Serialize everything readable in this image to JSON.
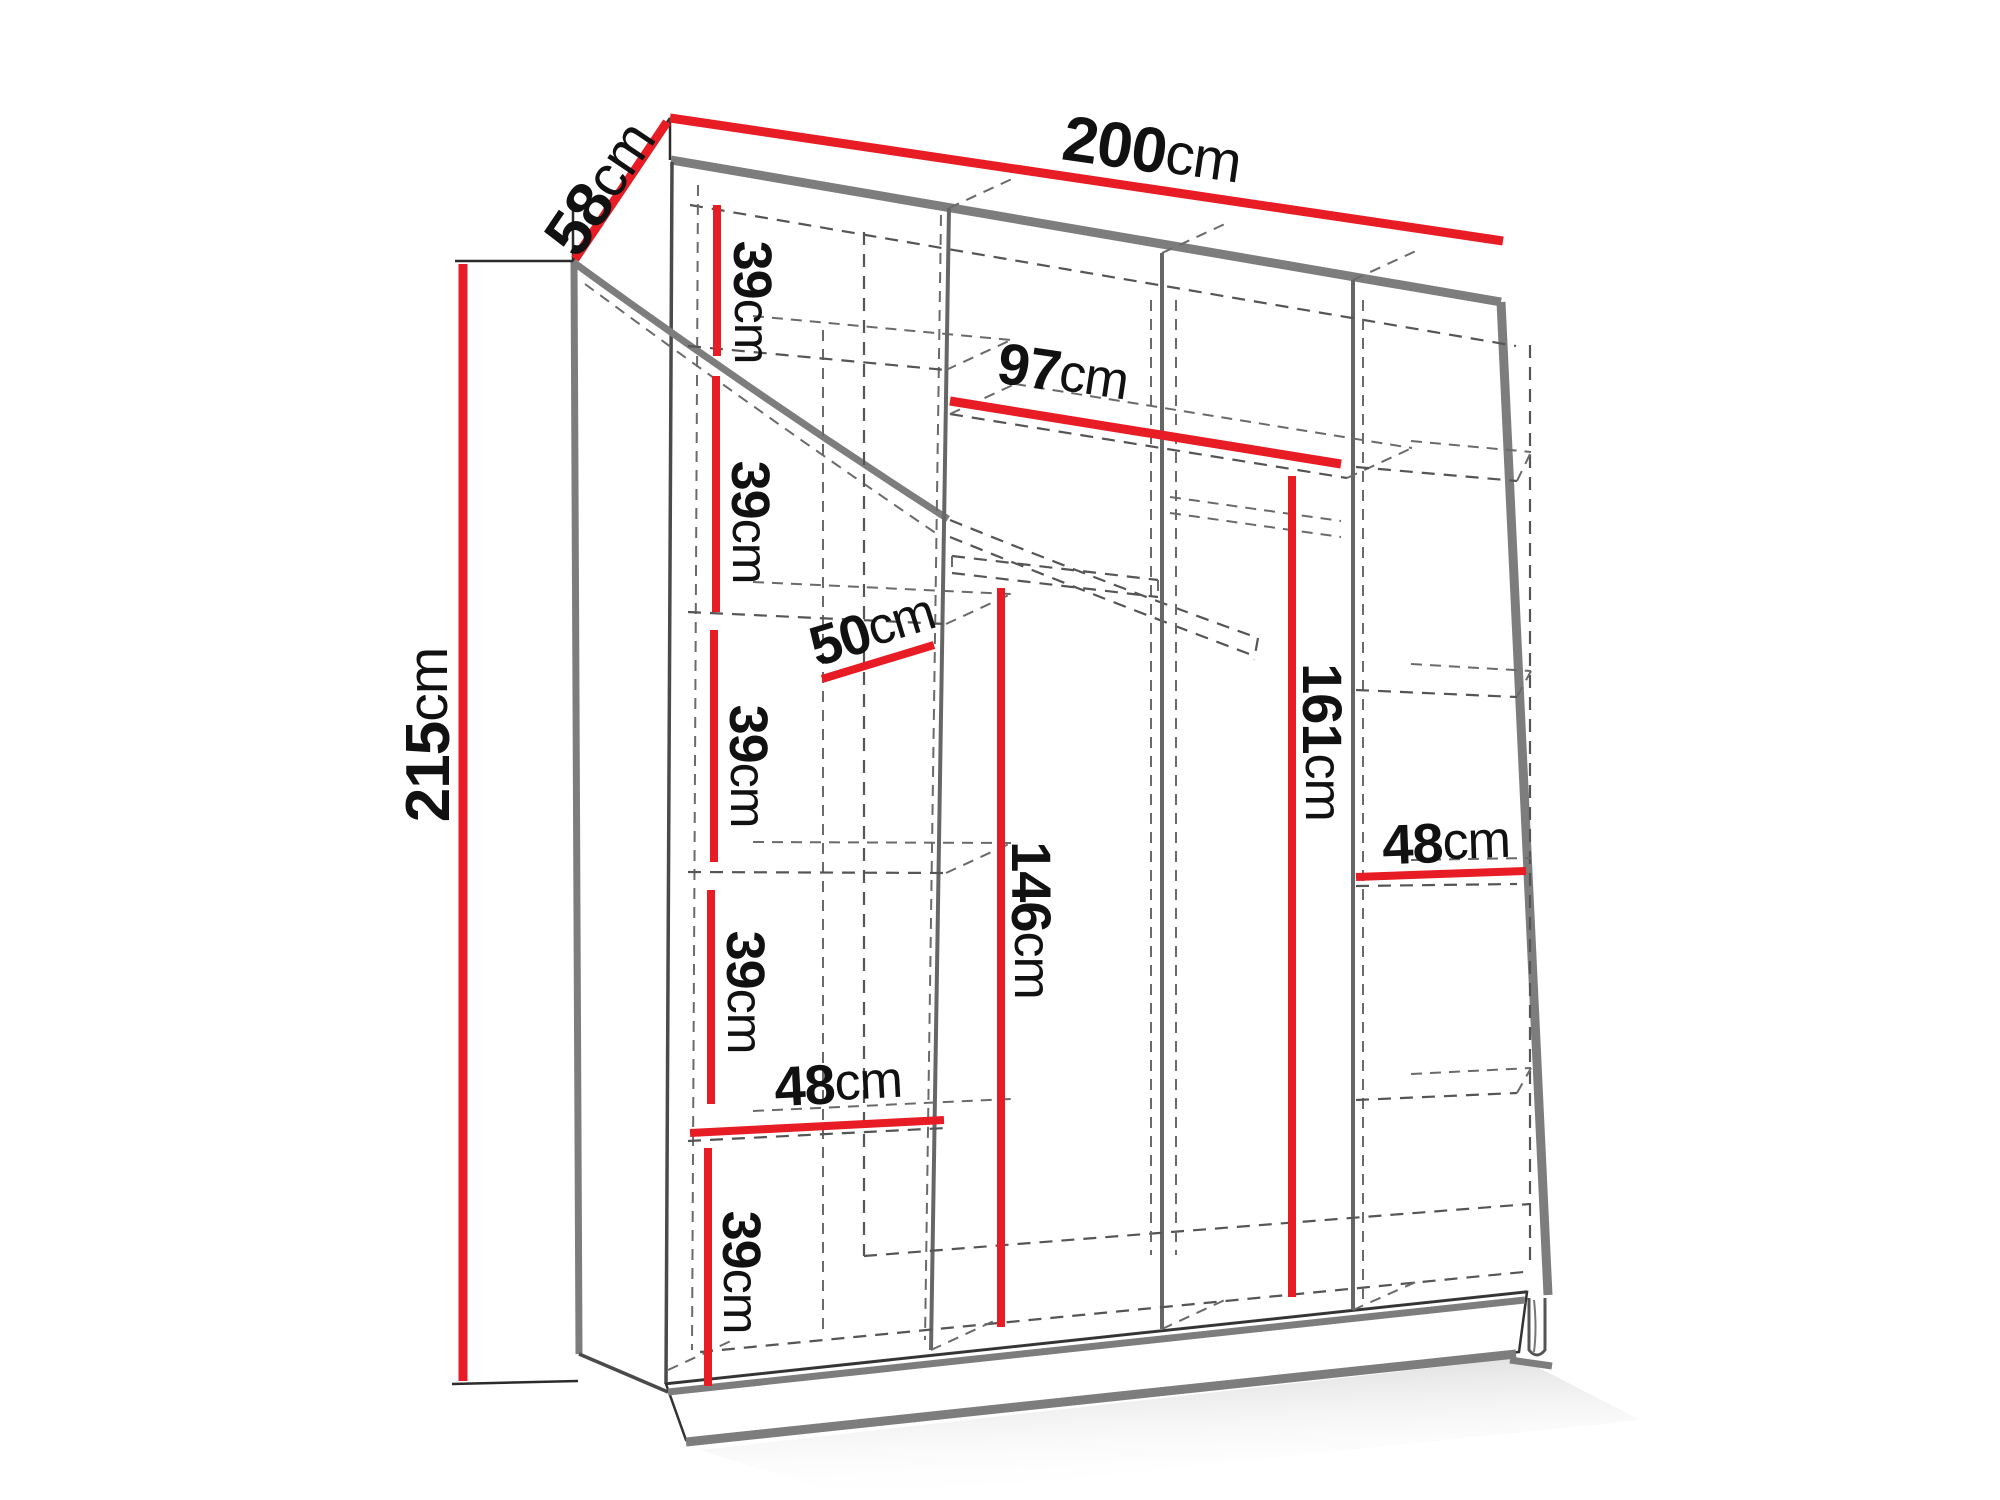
{
  "diagram": {
    "type": "furniture-dimension-diagram",
    "subject": "wardrobe-interior-dimensions",
    "unit": "cm",
    "colors": {
      "dimension_accent": "#e81c24",
      "outline_gray": "#7d7d7d",
      "line_dark": "#2b2b2b",
      "background": "#ffffff"
    },
    "labels": {
      "width": {
        "value": "200",
        "unit": "cm"
      },
      "depth": {
        "value": "58",
        "unit": "cm"
      },
      "height": {
        "value": "215",
        "unit": "cm"
      },
      "middle_width": {
        "value": "97",
        "unit": "cm"
      },
      "shelf_depth": {
        "value": "50",
        "unit": "cm"
      },
      "left_shelf_width": {
        "value": "48",
        "unit": "cm"
      },
      "right_shelf_width": {
        "value": "48",
        "unit": "cm"
      },
      "hanging_left": {
        "value": "146",
        "unit": "cm"
      },
      "hanging_right": {
        "value": "161",
        "unit": "cm"
      },
      "shelf_gaps": [
        {
          "value": "39",
          "unit": "cm"
        },
        {
          "value": "39",
          "unit": "cm"
        },
        {
          "value": "39",
          "unit": "cm"
        },
        {
          "value": "39",
          "unit": "cm"
        },
        {
          "value": "39",
          "unit": "cm"
        }
      ]
    }
  }
}
